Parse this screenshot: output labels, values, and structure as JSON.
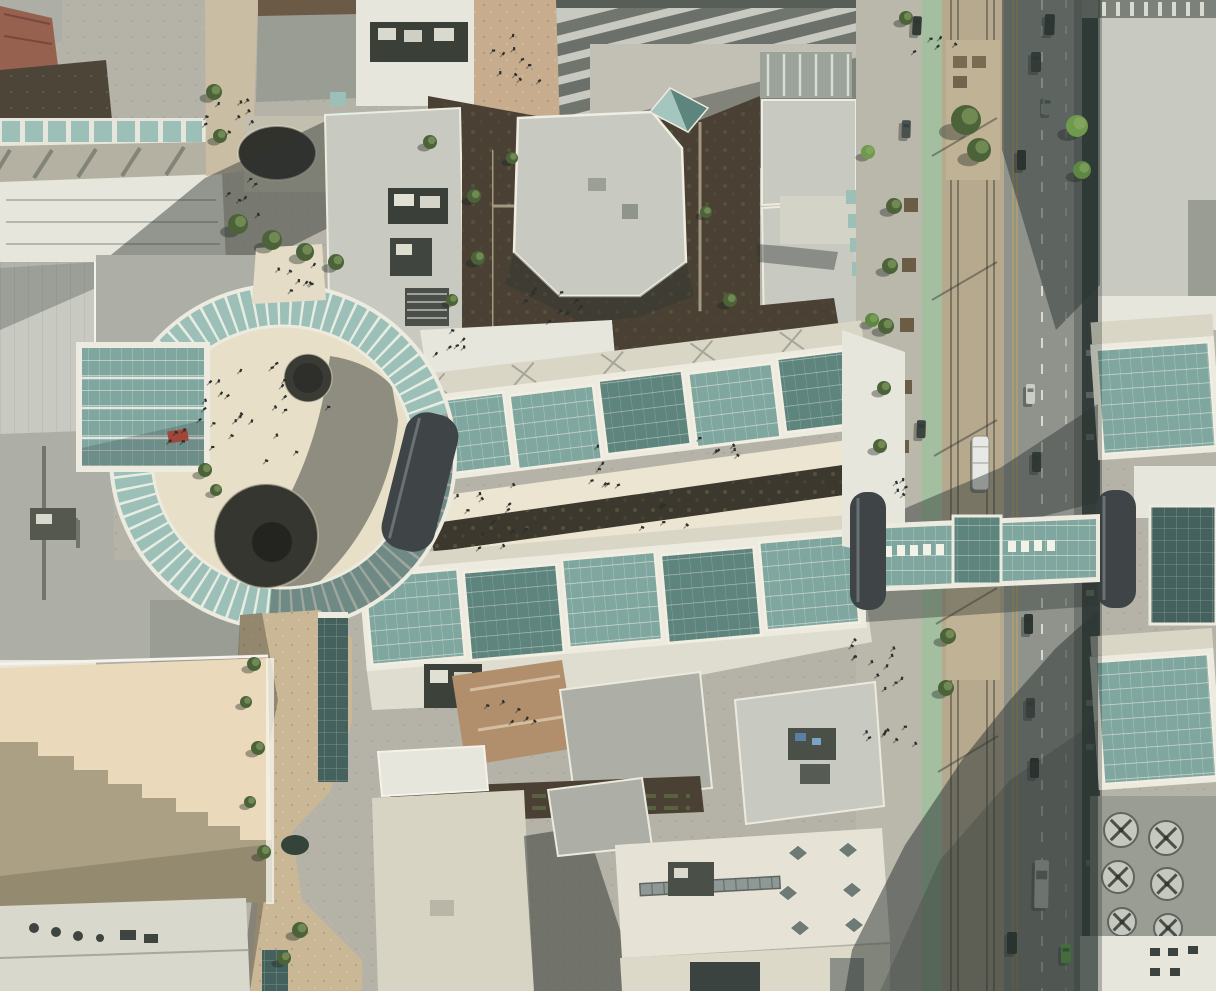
{
  "image": {
    "kind": "aerial-orthophoto",
    "width": 1216,
    "height": 991,
    "description": "Vertical aerial photograph of a downtown shopping-center superblock: a circular glass-canopy plaza with fountains, two long retractable glass atrium roofs flanking an open-air creek galleria, a glass skybridge crossing a light-rail street, surrounding rooftops with HVAC equipment, landscaped creek walk, street trees, cars and pedestrians."
  },
  "palette": {
    "pavement": "#b5b2a7",
    "pavementLight": "#c6c3b6",
    "roofLight": "#c8c9c1",
    "roofMid": "#adafa6",
    "roofGray": "#9a9d94",
    "roofDark": "#82857d",
    "roofWhite": "#e7e6dc",
    "cream": "#ece5d1",
    "plaza": "#e8dfc9",
    "glass": "#7fa7a0",
    "glassLight": "#a5c6be",
    "glassDark": "#5e847e",
    "glassDeep": "#44615d",
    "ringGlass": "#9cc0b8",
    "mullion": "#edebdf",
    "vault": "#3f4447",
    "asphalt": "#90938c",
    "bike": "#a4bf9f",
    "median": "#b6a98e",
    "tan": "#ead9ba",
    "garden": "#4a4134",
    "terracotta": "#b18f6d",
    "treeDark": "#4c6339",
    "treeLight": "#74904f",
    "redAwning": "#a1463a",
    "redRoof": "#97614f",
    "white": "#f4f2ea",
    "shadow": "#2c3633",
    "water": "#35443a",
    "carGreen": "#6ecf4f",
    "steel": "#8e9894",
    "rock": "#c9b796"
  },
  "scene": {
    "features": [
      "circular-glass-canopy-plaza",
      "retractable-glass-roof-wings",
      "open-air-creek-galleria",
      "glass-skybridge",
      "dark-barrel-vaults",
      "light-rail-street-with-green-bike-lane",
      "transit-median-platform",
      "stepped-tower-shadow-on-tan-roof",
      "landscaped-creek-walk",
      "rooftop-hvac-equipment",
      "sidewalk-cafes",
      "oval-fountain",
      "round-fountains",
      "street-trees",
      "pedestrians"
    ],
    "trees": [
      {
        "x": 966,
        "y": 120,
        "r": 15
      },
      {
        "x": 979,
        "y": 150,
        "r": 12
      },
      {
        "x": 948,
        "y": 636,
        "r": 8
      },
      {
        "x": 946,
        "y": 688,
        "r": 8
      },
      {
        "x": 1077,
        "y": 126,
        "r": 11,
        "c": "#6f9a4e"
      },
      {
        "x": 1082,
        "y": 170,
        "r": 9,
        "c": "#5d8742"
      },
      {
        "x": 894,
        "y": 206,
        "r": 8
      },
      {
        "x": 890,
        "y": 266,
        "r": 8
      },
      {
        "x": 886,
        "y": 326,
        "r": 8
      },
      {
        "x": 884,
        "y": 388,
        "r": 7
      },
      {
        "x": 880,
        "y": 446,
        "r": 7
      },
      {
        "x": 868,
        "y": 152,
        "r": 7,
        "c": "#6f9a4e"
      },
      {
        "x": 872,
        "y": 320,
        "r": 7,
        "c": "#5d8742"
      },
      {
        "x": 214,
        "y": 92,
        "r": 8
      },
      {
        "x": 220,
        "y": 136,
        "r": 7
      },
      {
        "x": 238,
        "y": 224,
        "r": 10
      },
      {
        "x": 272,
        "y": 240,
        "r": 10
      },
      {
        "x": 305,
        "y": 252,
        "r": 9
      },
      {
        "x": 336,
        "y": 262,
        "r": 8
      },
      {
        "x": 430,
        "y": 142,
        "r": 7
      },
      {
        "x": 474,
        "y": 196,
        "r": 7
      },
      {
        "x": 478,
        "y": 258,
        "r": 7
      },
      {
        "x": 512,
        "y": 158,
        "r": 6
      },
      {
        "x": 452,
        "y": 300,
        "r": 6
      },
      {
        "x": 706,
        "y": 212,
        "r": 6
      },
      {
        "x": 730,
        "y": 300,
        "r": 7
      },
      {
        "x": 254,
        "y": 664,
        "r": 7
      },
      {
        "x": 246,
        "y": 702,
        "r": 6
      },
      {
        "x": 258,
        "y": 748,
        "r": 7
      },
      {
        "x": 250,
        "y": 802,
        "r": 6
      },
      {
        "x": 264,
        "y": 852,
        "r": 7
      },
      {
        "x": 300,
        "y": 930,
        "r": 8
      },
      {
        "x": 284,
        "y": 958,
        "r": 7
      },
      {
        "x": 205,
        "y": 470,
        "r": 7
      },
      {
        "x": 216,
        "y": 490,
        "r": 6
      },
      {
        "x": 906,
        "y": 18,
        "r": 7
      }
    ],
    "people_clusters": [
      {
        "x": 262,
        "y": 412,
        "r": 68,
        "n": 26
      },
      {
        "x": 292,
        "y": 274,
        "r": 26,
        "n": 8
      },
      {
        "x": 230,
        "y": 118,
        "r": 30,
        "n": 9
      },
      {
        "x": 245,
        "y": 198,
        "r": 26,
        "n": 6
      },
      {
        "x": 520,
        "y": 62,
        "r": 36,
        "n": 10
      },
      {
        "x": 562,
        "y": 312,
        "r": 42,
        "n": 9
      },
      {
        "x": 452,
        "y": 348,
        "r": 26,
        "n": 6
      },
      {
        "x": 484,
        "y": 494,
        "r": 34,
        "n": 7
      },
      {
        "x": 604,
        "y": 468,
        "r": 34,
        "n": 7
      },
      {
        "x": 722,
        "y": 448,
        "r": 28,
        "n": 6
      },
      {
        "x": 506,
        "y": 542,
        "r": 30,
        "n": 6
      },
      {
        "x": 664,
        "y": 518,
        "r": 28,
        "n": 5
      },
      {
        "x": 884,
        "y": 660,
        "r": 40,
        "n": 12
      },
      {
        "x": 892,
        "y": 736,
        "r": 30,
        "n": 8
      },
      {
        "x": 902,
        "y": 486,
        "r": 18,
        "n": 5
      },
      {
        "x": 180,
        "y": 430,
        "r": 18,
        "n": 4
      },
      {
        "x": 512,
        "y": 712,
        "r": 30,
        "n": 6
      },
      {
        "x": 934,
        "y": 50,
        "r": 24,
        "n": 5
      }
    ],
    "cars": [
      {
        "x": 1045,
        "y": 14,
        "w": 10,
        "h": 21,
        "a": 2,
        "c": "#2f3733"
      },
      {
        "x": 1031,
        "y": 52,
        "w": 10,
        "h": 20,
        "a": 0,
        "c": "#39413d"
      },
      {
        "x": 1043,
        "y": 96,
        "w": 9,
        "h": 19,
        "a": 0,
        "c": "#8f958f"
      },
      {
        "x": 1017,
        "y": 150,
        "w": 9,
        "h": 20,
        "a": 0,
        "c": "#2b332f"
      },
      {
        "x": 913,
        "y": 16,
        "w": 9,
        "h": 19,
        "a": 3,
        "c": "#333b37"
      },
      {
        "x": 902,
        "y": 120,
        "w": 9,
        "h": 18,
        "a": 2,
        "c": "#4a524d"
      },
      {
        "x": 1026,
        "y": 384,
        "w": 9,
        "h": 20,
        "a": 0,
        "c": "#caccc6"
      },
      {
        "x": 1032,
        "y": 452,
        "w": 9,
        "h": 20,
        "a": 0,
        "c": "#343c38"
      },
      {
        "x": 1024,
        "y": 614,
        "w": 9,
        "h": 20,
        "a": 0,
        "c": "#2e3632"
      },
      {
        "x": 1026,
        "y": 698,
        "w": 9,
        "h": 20,
        "a": 0,
        "c": "#454d48"
      },
      {
        "x": 1030,
        "y": 758,
        "w": 9,
        "h": 20,
        "a": 0,
        "c": "#242a28"
      },
      {
        "x": 1035,
        "y": 860,
        "w": 14,
        "h": 48,
        "a": 1,
        "c": "#e2e3dd"
      },
      {
        "x": 1007,
        "y": 932,
        "w": 10,
        "h": 22,
        "a": 0,
        "c": "#272e2b"
      },
      {
        "x": 1061,
        "y": 944,
        "w": 10,
        "h": 19,
        "a": 0,
        "c": "#6ecf4f"
      },
      {
        "x": 917,
        "y": 420,
        "w": 9,
        "h": 18,
        "a": 2,
        "c": "#3c443f"
      }
    ],
    "train": {
      "x": 972,
      "y": 436,
      "w": 17,
      "h": 54
    },
    "fans": [
      {
        "x": 1121,
        "y": 830,
        "r": 17
      },
      {
        "x": 1166,
        "y": 838,
        "r": 17
      },
      {
        "x": 1118,
        "y": 877,
        "r": 16
      },
      {
        "x": 1167,
        "y": 884,
        "r": 16
      },
      {
        "x": 1122,
        "y": 922,
        "r": 14
      },
      {
        "x": 1168,
        "y": 928,
        "r": 14
      }
    ]
  }
}
